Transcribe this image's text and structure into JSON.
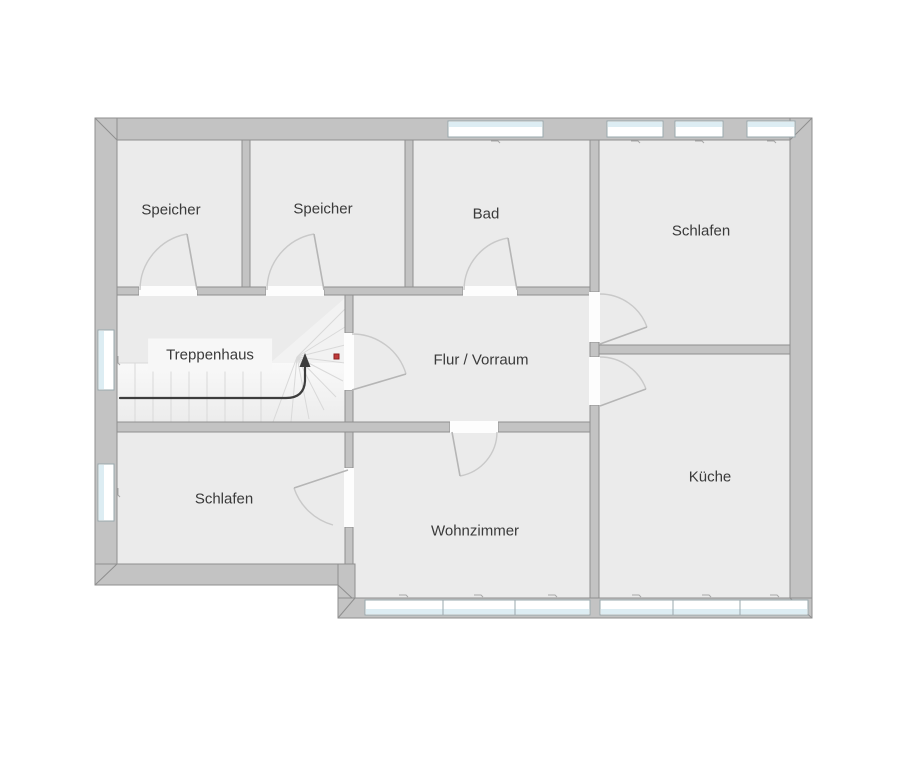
{
  "plan": {
    "title": "Obergeschoss Grundriss",
    "rooms": [
      {
        "id": "speicher-1",
        "label": "Speicher"
      },
      {
        "id": "speicher-2",
        "label": "Speicher"
      },
      {
        "id": "bad",
        "label": "Bad"
      },
      {
        "id": "schlafen-top",
        "label": "Schlafen"
      },
      {
        "id": "treppenhaus",
        "label": "Treppenhaus"
      },
      {
        "id": "flur-vorraum",
        "label": "Flur / Vorraum"
      },
      {
        "id": "kueche",
        "label": "Küche"
      },
      {
        "id": "schlafen-bottom",
        "label": "Schlafen"
      },
      {
        "id": "wohnzimmer",
        "label": "Wohnzimmer"
      }
    ],
    "colors": {
      "wall": "#c3c3c3",
      "wall_outline": "#8f8f8f",
      "floor": "#ebebeb",
      "window_glass": "#ddedf3",
      "door_arc": "#c9c9c9",
      "stair_line": "#d9d9d9",
      "arrow": "#3d3d3d",
      "marker": "#c03a3a",
      "label_text": "#3a3a3a"
    }
  }
}
